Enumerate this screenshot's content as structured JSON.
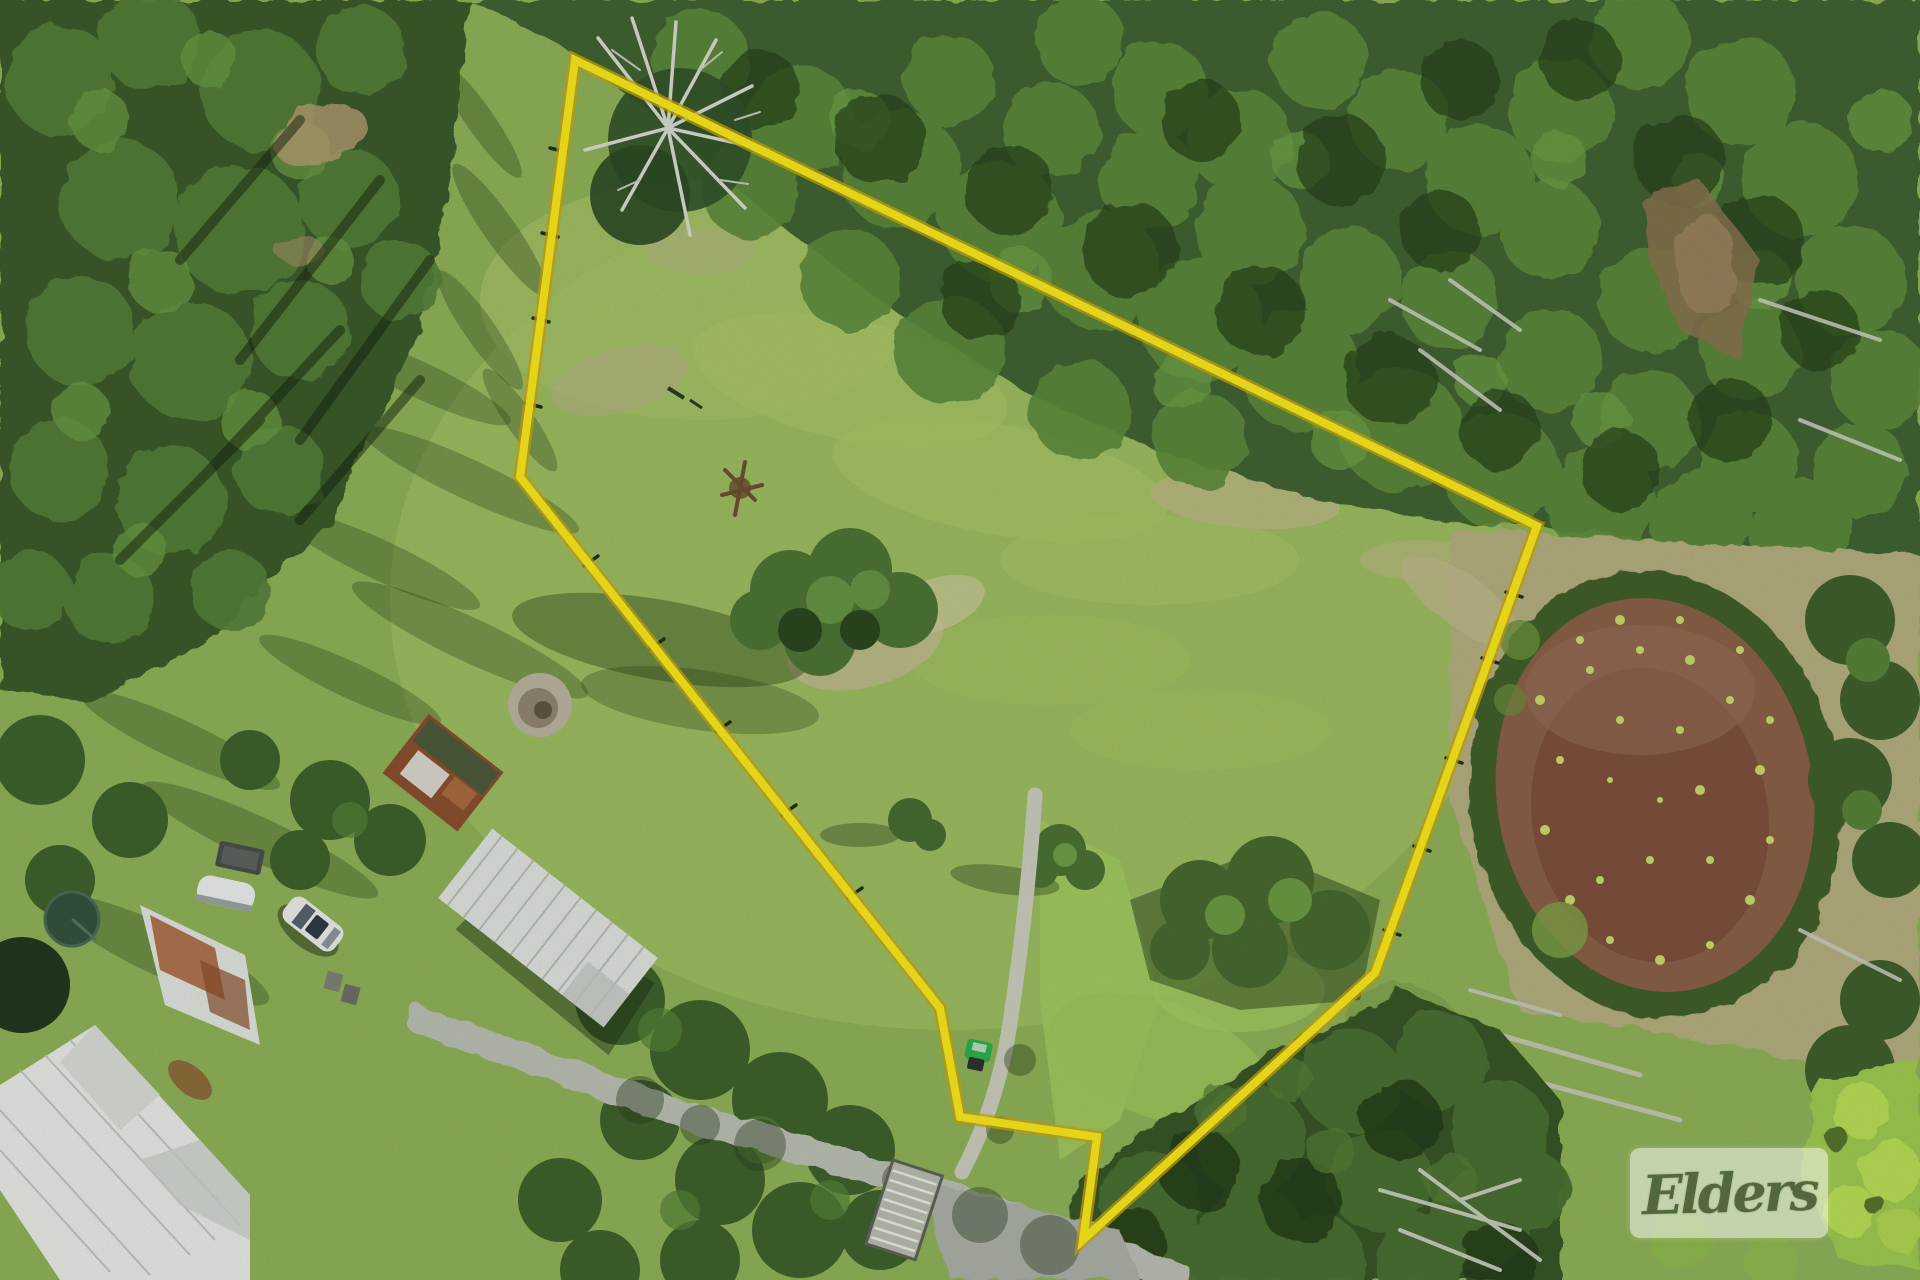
{
  "image": {
    "kind": "aerial-drone-photo-of-rural-property",
    "watermark": {
      "brand": "Elders"
    },
    "boundary": {
      "color": "#f8e71c",
      "edge_color": "#c9a50f",
      "points": "575,60 1537,526 1375,973 1083,1240 1097,1137 960,1117 940,1008 520,477"
    },
    "palette": {
      "grass_base": "#8fb158",
      "paddock": "#9cbc60",
      "forest": "#3e602d",
      "forest_dark": "#27431c",
      "pond_mud": "#8a6047",
      "lily_green": "#c8d96b",
      "road_gravel": "#b9beb2",
      "driveway": "#c9cbbb",
      "roof_white": "#e6e9e4",
      "roof_rust": "#a65e35"
    }
  }
}
